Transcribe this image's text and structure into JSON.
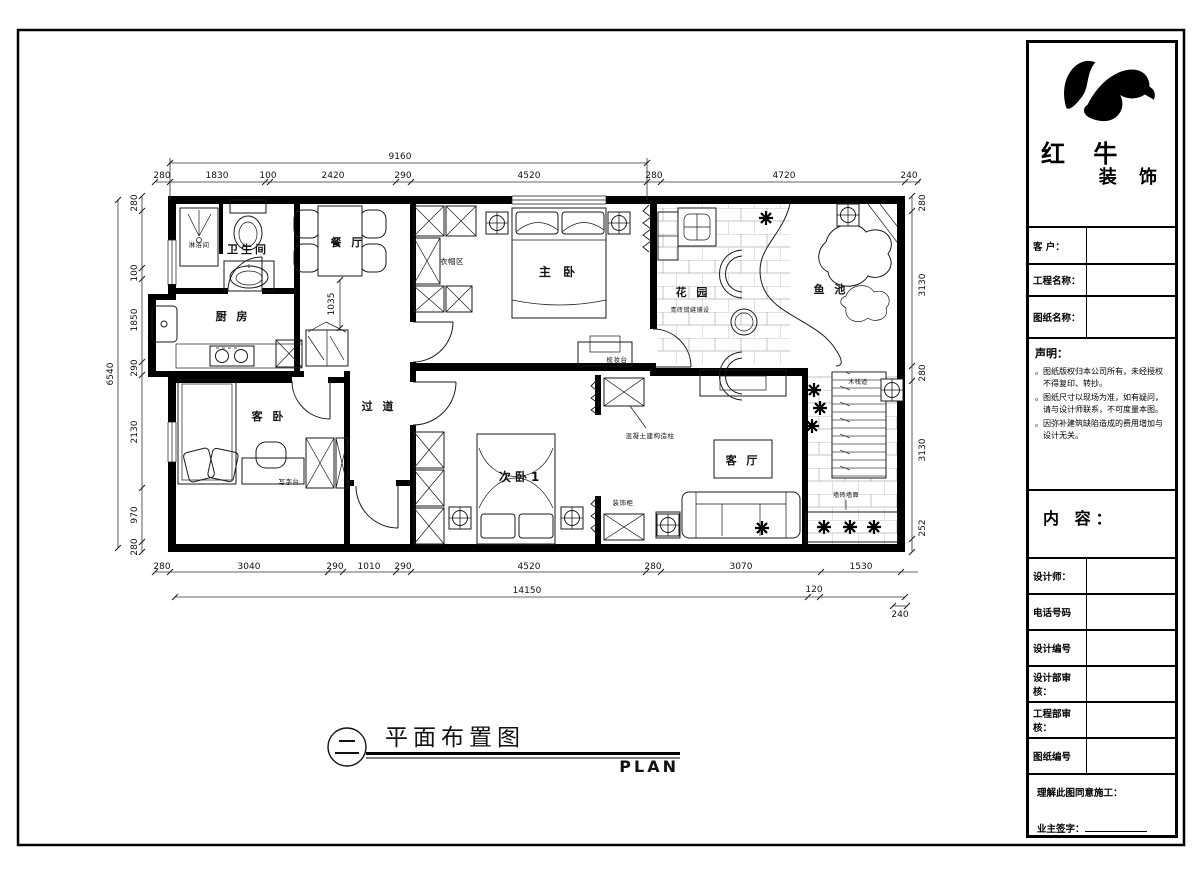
{
  "brand": {
    "name_top": "红 牛",
    "name_bottom": "装 饰"
  },
  "title_block": {
    "customer_label": "客 户：",
    "project_label": "工程名称：",
    "drawing_label": "图纸名称：",
    "statement_heading": "声明：",
    "statement_items": [
      "图纸版权归本公司所有，未经授权不得复印、转抄。",
      "图纸尺寸以现场为准，如有疑问，请与设计师联系，不可度量本图。",
      "因弥补建筑缺陷造成的费用增加与设计无关。"
    ],
    "content_label": "内 容：",
    "designer_label": "设计师：",
    "phone_label": "电话号码",
    "design_no_label": "设计编号",
    "design_review_label": "设计部审核：",
    "engineering_review_label": "工程部审核：",
    "drawing_no_label": "图纸编号",
    "agree_label": "理解此图同意施工：",
    "owner_sign_label": "业主签字："
  },
  "caption": {
    "title": "平面布置图",
    "subtitle": "PLAN"
  },
  "plan": {
    "rooms": {
      "shower": "淋浴间",
      "bathroom": "卫生间",
      "dining": "餐 厅",
      "kitchen": "厨 房",
      "corridor": "过 道",
      "guest_bedroom": "客 卧",
      "master_bedroom": "主 卧",
      "cloak_area": "衣帽区",
      "bedroom2": "次卧1",
      "living_room": "客 厅",
      "garden": "花 园",
      "fish_pond": "鱼 池"
    },
    "annotations": {
      "dressing_table": "梳妆台",
      "desk": "写字台",
      "concrete_column": "混凝土建构造柱",
      "decor_cabinet": "装饰柜",
      "garden_paving": "青砖错缝铺设",
      "boardwalk": "木栈道",
      "wall_tile": "墙砖墙面",
      "dining_dim": "1035"
    },
    "dims": {
      "top1": [
        "9160"
      ],
      "top2": [
        "280",
        "1830",
        "100",
        "2420",
        "290",
        "4520",
        "280",
        "4720",
        "240"
      ],
      "left1": [
        "6540"
      ],
      "left2": [
        "280",
        "100",
        "1850",
        "290",
        "2130",
        "970",
        "280"
      ],
      "right": [
        "280",
        "3130",
        "280",
        "3130",
        "252"
      ],
      "bottom1": [
        "280",
        "3040",
        "290",
        "1010",
        "290",
        "4520",
        "280",
        "3070",
        "1530"
      ],
      "bottom2": [
        "14150",
        "120",
        "240"
      ]
    }
  }
}
